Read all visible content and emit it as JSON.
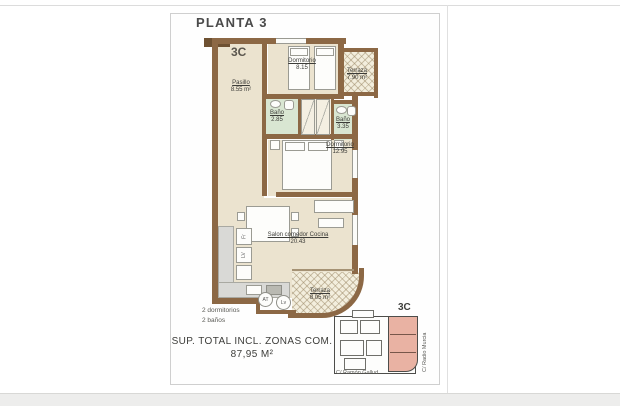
{
  "title": "PLANTA 3",
  "unit": "3C",
  "rooms": {
    "pasillo": {
      "name": "Pasillo",
      "area": "8.55 m²"
    },
    "dormitorio1": {
      "name": "Dormitorio",
      "area": "8.15"
    },
    "terraza1": {
      "name": "Terraza",
      "area": "7.90 m²"
    },
    "bano1": {
      "name": "Baño",
      "area": "2.85"
    },
    "bano2": {
      "name": "Baño",
      "area": "3.35"
    },
    "dormitorio2": {
      "name": "Dormitorio",
      "area": "12.95"
    },
    "salon": {
      "name": "Salon comedor Cocina",
      "area": "20.43"
    },
    "terraza2": {
      "name": "Terraza",
      "area": "8.05 m²"
    }
  },
  "appliances": {
    "fridge": "Fr",
    "dishwasher": "LV",
    "at": "AT",
    "washer": "Lv"
  },
  "summary": {
    "bedrooms": "2 dormitorios",
    "bathrooms": "2 baños",
    "total_label": "SUP. TOTAL INCL. ZONAS COM.",
    "total_value": "87,95 M²"
  },
  "keyplan": {
    "unit": "3C",
    "street_bottom": "C/ Ramón Gallud",
    "street_right": "C/ Radio Murcia"
  },
  "colors": {
    "wall": "#8c6845",
    "room": "#ebe3cf",
    "bath": "#d9e6d2",
    "terrace": "#f3eedd",
    "highlight": "#e9b2a3"
  }
}
